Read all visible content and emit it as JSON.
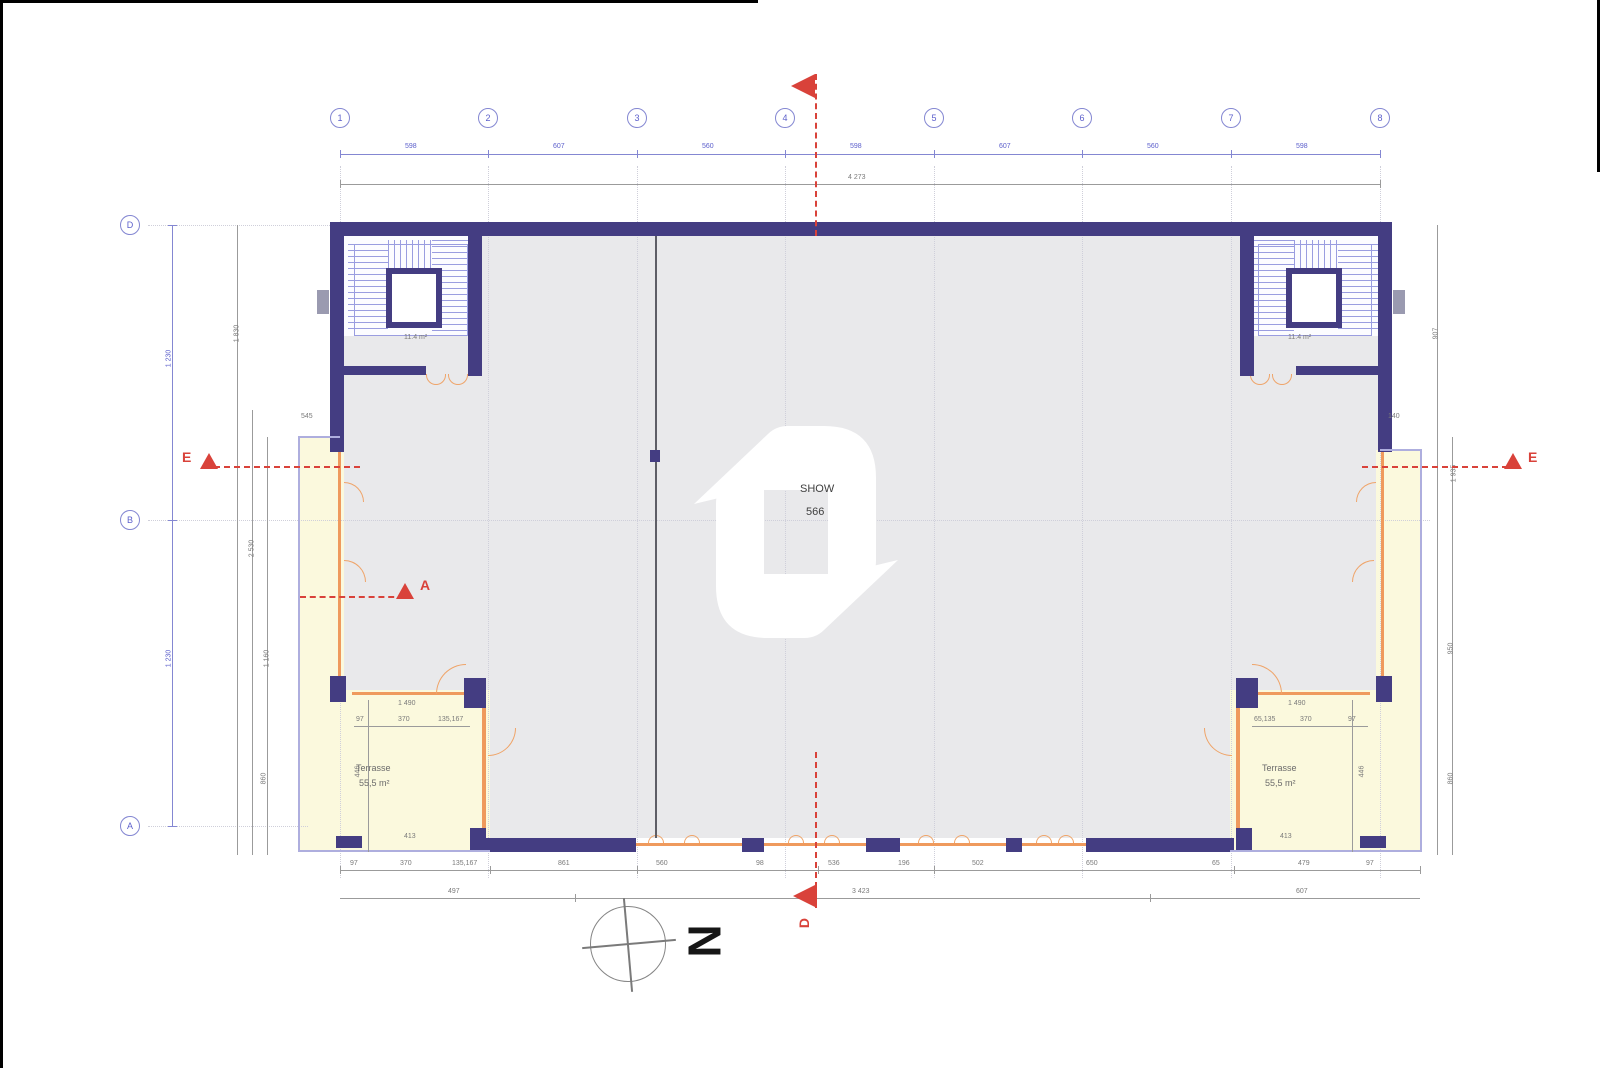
{
  "grid": {
    "top": [
      "1",
      "2",
      "3",
      "4",
      "5",
      "6",
      "7",
      "8"
    ],
    "left": [
      "D",
      "B",
      "A"
    ]
  },
  "dims": {
    "top_bays": [
      "598",
      "607",
      "560",
      "598",
      "607",
      "560",
      "598"
    ],
    "top_overall": "4 273",
    "left_bays": [
      "1 230",
      "1 230"
    ],
    "left_aux": [
      "1 830",
      "2 530",
      "1 160",
      "860"
    ],
    "right_aux": [
      "907",
      "1 935",
      "950",
      "860"
    ],
    "left_offset": "545",
    "right_offset": "140",
    "bottom_row1": [
      "97",
      "370",
      "135,167",
      "861",
      "560",
      "98",
      "536",
      "196",
      "502",
      "650",
      "65",
      "479",
      "97"
    ],
    "bottom_row2": [
      "497",
      "3 423",
      "607"
    ]
  },
  "rooms": {
    "showroom": {
      "line1": "SHOW",
      "line2": "566"
    },
    "stair_left_area": "11.4 m²",
    "stair_right_area": "11.4 m²",
    "terrace_left": {
      "name": "Terrasse",
      "area": "55,5 m²",
      "dim_top": "1 490",
      "dim_w1": "97",
      "dim_w2": "370",
      "dim_w3": "135,167",
      "dim_h": "446",
      "dim_bottom": "413"
    },
    "terrace_right": {
      "name": "Terrasse",
      "area": "55,5 m²",
      "dim_top": "1 490",
      "dim_w1": "65,135",
      "dim_w2": "370",
      "dim_w3": "97",
      "dim_h": "446",
      "dim_bottom": "413"
    }
  },
  "sections": {
    "e_left": "E",
    "e_right": "E",
    "a": "A",
    "d": "D"
  },
  "compass": {
    "north": "N"
  },
  "colors": {
    "wall": "#443d82",
    "glazing": "#ef9a5d",
    "terrace_fill": "#fbf9dd",
    "interior_fill": "#e9e9eb",
    "grid_blue": "#8487d2",
    "section_red": "#d9423a"
  }
}
